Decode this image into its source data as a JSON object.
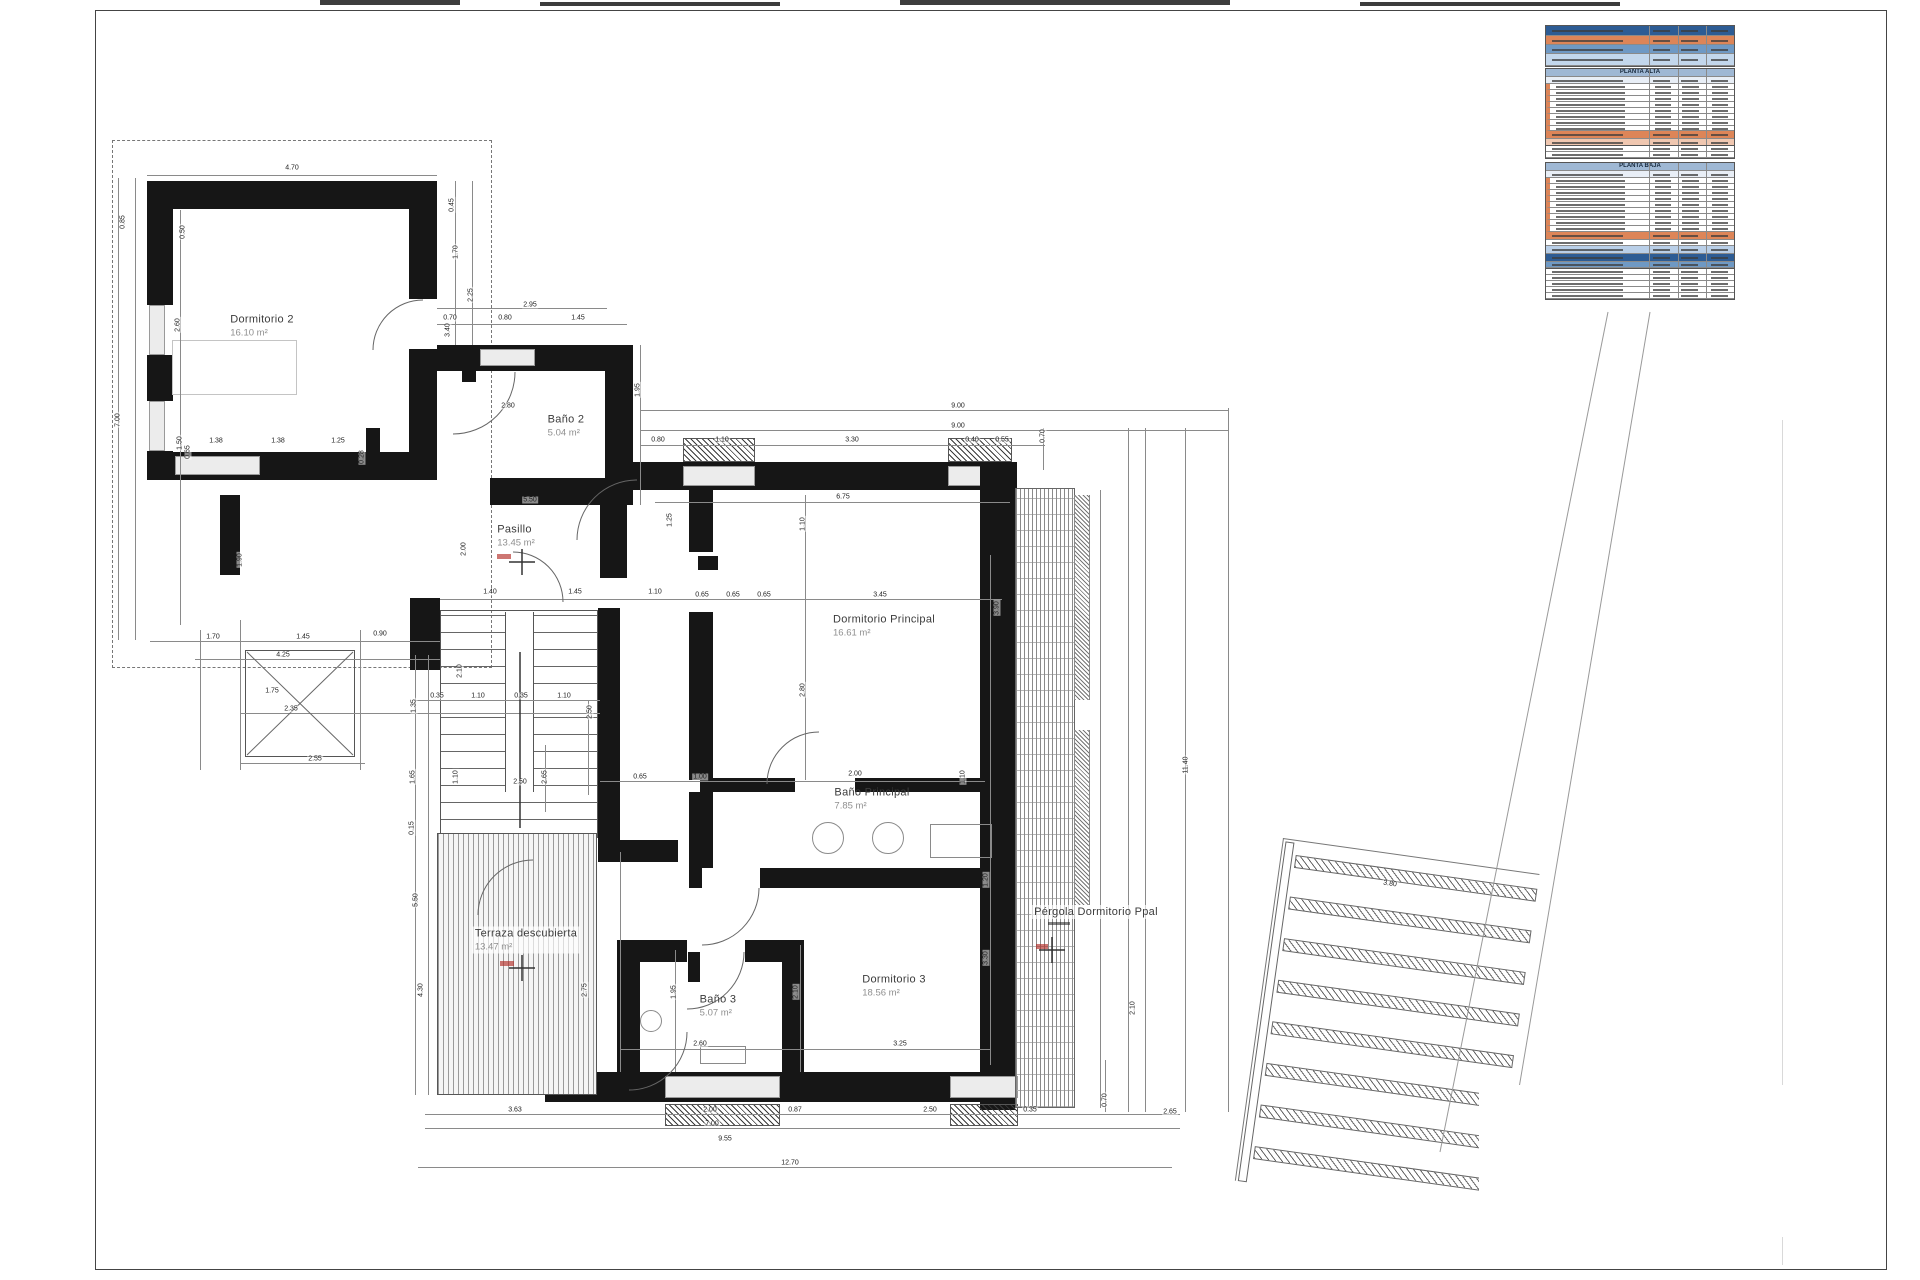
{
  "rooms": [
    {
      "name": "Dormitorio 2",
      "area": "16.10 m²",
      "x": 262,
      "y": 326,
      "boxed": false
    },
    {
      "name": "Baño 2",
      "area": "5.04 m²",
      "x": 566,
      "y": 426,
      "boxed": false
    },
    {
      "name": "Pasillo",
      "area": "13.45 m²",
      "x": 516,
      "y": 536,
      "boxed": false
    },
    {
      "name": "Dormitorio Principal",
      "area": "16.61 m²",
      "x": 884,
      "y": 626,
      "boxed": false
    },
    {
      "name": "Baño Principal",
      "area": "7.85 m²",
      "x": 872,
      "y": 799,
      "boxed": false
    },
    {
      "name": "Dormitorio 3",
      "area": "18.56 m²",
      "x": 894,
      "y": 986,
      "boxed": false
    },
    {
      "name": "Baño 3",
      "area": "5.07 m²",
      "x": 718,
      "y": 1006,
      "boxed": false
    },
    {
      "name": "Terraza descubierta",
      "area": "13.47 m²",
      "x": 526,
      "y": 940,
      "boxed": true
    },
    {
      "name": "Pérgola Dormitorio Ppal",
      "area": "",
      "x": 1096,
      "y": 912,
      "boxed": true
    }
  ],
  "dimensions": [
    [
      "4.70",
      292,
      168,
      0
    ],
    [
      "0.85",
      123,
      222,
      -90
    ],
    [
      "0.50",
      183,
      232,
      -90
    ],
    [
      "2.60",
      178,
      325,
      -90
    ],
    [
      "7.00",
      118,
      420,
      -90
    ],
    [
      "1.50",
      180,
      443,
      -90
    ],
    [
      "3.40",
      448,
      330,
      -90
    ],
    [
      "0.45",
      452,
      205,
      -90
    ],
    [
      "1.70",
      456,
      252,
      -90
    ],
    [
      "2.25",
      471,
      295,
      -90
    ],
    [
      "2.95",
      530,
      305,
      0
    ],
    [
      "0.70",
      450,
      318,
      0
    ],
    [
      "0.80",
      505,
      318,
      0
    ],
    [
      "1.45",
      578,
      318,
      0
    ],
    [
      "2.80",
      508,
      406,
      0
    ],
    [
      "1.95",
      638,
      390,
      -90
    ],
    [
      "1.38",
      216,
      441,
      0
    ],
    [
      "1.38",
      278,
      441,
      0
    ],
    [
      "1.25",
      338,
      441,
      0
    ],
    [
      "0.65",
      188,
      452,
      -90
    ],
    [
      "0.28",
      362,
      457,
      -90
    ],
    [
      "5.50",
      530,
      500,
      0
    ],
    [
      "2.00",
      464,
      549,
      -90
    ],
    [
      "1.25",
      670,
      520,
      -90
    ],
    [
      "1.10",
      803,
      524,
      -90
    ],
    [
      "1.40",
      490,
      592,
      0
    ],
    [
      "1.45",
      575,
      592,
      0
    ],
    [
      "1.10",
      655,
      592,
      0
    ],
    [
      "0.65",
      702,
      595,
      0
    ],
    [
      "0.65",
      733,
      595,
      0
    ],
    [
      "0.65",
      764,
      595,
      0
    ],
    [
      "3.45",
      880,
      595,
      0
    ],
    [
      "3.90",
      997,
      608,
      -90
    ],
    [
      "2.80",
      803,
      690,
      -90
    ],
    [
      "6.75",
      843,
      497,
      0
    ],
    [
      "9.00",
      958,
      406,
      0
    ],
    [
      "9.00",
      958,
      426,
      0
    ],
    [
      "0.80",
      658,
      440,
      0
    ],
    [
      "1.10",
      722,
      440,
      0
    ],
    [
      "3.30",
      852,
      440,
      0
    ],
    [
      "0.40",
      972,
      440,
      0
    ],
    [
      "0.55",
      1002,
      440,
      0
    ],
    [
      "0.70",
      1043,
      436,
      -90
    ],
    [
      "11.40",
      1186,
      765,
      -90
    ],
    [
      "0.90",
      380,
      634,
      0
    ],
    [
      "1.70",
      213,
      637,
      0
    ],
    [
      "1.45",
      303,
      637,
      0
    ],
    [
      "4.25",
      283,
      655,
      0
    ],
    [
      "1.90",
      240,
      560,
      -90
    ],
    [
      "1.75",
      272,
      691,
      0
    ],
    [
      "2.35",
      291,
      709,
      0
    ],
    [
      "2.55",
      315,
      759,
      0
    ],
    [
      "0.35",
      437,
      696,
      0
    ],
    [
      "1.10",
      478,
      696,
      0
    ],
    [
      "0.35",
      521,
      696,
      0
    ],
    [
      "1.10",
      564,
      696,
      0
    ],
    [
      "2.10",
      460,
      671,
      -90
    ],
    [
      "1.35",
      414,
      706,
      -90
    ],
    [
      "1.65",
      413,
      777,
      -90
    ],
    [
      "0.15",
      412,
      828,
      -90
    ],
    [
      "1.10",
      456,
      777,
      -90
    ],
    [
      "2.50",
      520,
      782,
      0
    ],
    [
      "2.50",
      590,
      712,
      -90
    ],
    [
      "2.65",
      545,
      777,
      -90
    ],
    [
      "0.65",
      640,
      777,
      0
    ],
    [
      "1.00",
      700,
      777,
      0
    ],
    [
      "2.00",
      855,
      774,
      0
    ],
    [
      "1.10",
      963,
      777,
      -90
    ],
    [
      "5.50",
      416,
      900,
      -90
    ],
    [
      "4.30",
      421,
      990,
      -90
    ],
    [
      "2.75",
      585,
      990,
      -90
    ],
    [
      "1.95",
      674,
      992,
      -90
    ],
    [
      "2.10",
      796,
      992,
      -90
    ],
    [
      "3.30",
      986,
      958,
      -90
    ],
    [
      "1.20",
      986,
      880,
      -90
    ],
    [
      "3.25",
      900,
      1044,
      0
    ],
    [
      "2.60",
      700,
      1044,
      0
    ],
    [
      "3.63",
      515,
      1110,
      0
    ],
    [
      "2.00",
      710,
      1110,
      0
    ],
    [
      "0.87",
      795,
      1110,
      0
    ],
    [
      "2.50",
      930,
      1110,
      0
    ],
    [
      "0.35",
      1030,
      1110,
      0
    ],
    [
      "7.00",
      712,
      1124,
      0
    ],
    [
      "9.55",
      725,
      1139,
      0
    ],
    [
      "12.70",
      790,
      1163,
      0
    ],
    [
      "2.65",
      1170,
      1112,
      0
    ],
    [
      "0.70",
      1105,
      1100,
      -90
    ],
    [
      "2.10",
      1133,
      1008,
      -90
    ],
    [
      "3.80",
      1390,
      884,
      8
    ]
  ],
  "tables": {
    "panels": [
      {
        "top": 25,
        "left": 1545,
        "width": 190,
        "title": "",
        "rows": [
          {
            "t": "bandDark",
            "h": 10
          },
          {
            "t": "bandOrange",
            "h": 9
          },
          {
            "t": "bandBlue",
            "h": 9
          },
          {
            "t": "bandLight",
            "h": 12
          }
        ]
      },
      {
        "top": 68,
        "left": 1545,
        "width": 190,
        "title": "PLANTA ALTA",
        "rows": [
          {
            "t": "title",
            "h": 8
          },
          {
            "t": "colhead",
            "h": 7
          },
          {
            "t": "data",
            "h": 6
          },
          {
            "t": "data",
            "h": 6
          },
          {
            "t": "data",
            "h": 6
          },
          {
            "t": "data",
            "h": 6
          },
          {
            "t": "data",
            "h": 6
          },
          {
            "t": "data",
            "h": 6
          },
          {
            "t": "data",
            "h": 6
          },
          {
            "t": "data",
            "h": 5
          },
          {
            "t": "total",
            "h": 8
          },
          {
            "t": "footer",
            "h": 7
          }
        ]
      },
      {
        "top": 145,
        "left": 1545,
        "width": 190,
        "title": "",
        "rows": [
          {
            "t": "thin",
            "h": 6
          },
          {
            "t": "thin",
            "h": 6
          }
        ]
      },
      {
        "top": 162,
        "left": 1545,
        "width": 190,
        "title": "PLANTA BAJA",
        "rows": [
          {
            "t": "title",
            "h": 8
          },
          {
            "t": "colhead",
            "h": 7
          },
          {
            "t": "data",
            "h": 6
          },
          {
            "t": "data",
            "h": 6
          },
          {
            "t": "data",
            "h": 6
          },
          {
            "t": "data",
            "h": 6
          },
          {
            "t": "data",
            "h": 6
          },
          {
            "t": "data",
            "h": 6
          },
          {
            "t": "data",
            "h": 6
          },
          {
            "t": "data",
            "h": 6
          },
          {
            "t": "data",
            "h": 6
          },
          {
            "t": "total",
            "h": 8
          },
          {
            "t": "thin",
            "h": 6
          },
          {
            "t": "blueL",
            "h": 8
          },
          {
            "t": "bandDark",
            "h": 8
          },
          {
            "t": "bandBlue",
            "h": 6
          }
        ]
      },
      {
        "top": 268,
        "left": 1545,
        "width": 190,
        "title": "",
        "rows": [
          {
            "t": "thin",
            "h": 6
          },
          {
            "t": "thin",
            "h": 6
          },
          {
            "t": "thin",
            "h": 6
          },
          {
            "t": "thin",
            "h": 6
          },
          {
            "t": "thin",
            "h": 6
          }
        ]
      }
    ]
  }
}
